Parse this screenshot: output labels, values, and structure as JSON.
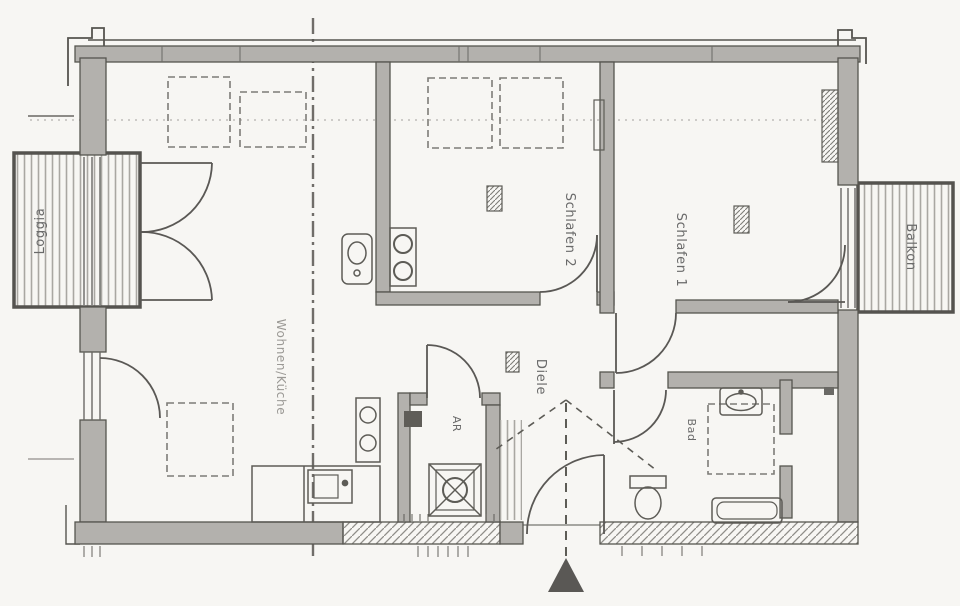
{
  "colors": {
    "paper": "#f7f6f3",
    "ink": "#4f4f4f",
    "ink_light": "#9a9894",
    "wall_fill": "#b3b1ad",
    "label": "#6a6a6a"
  },
  "rooms": {
    "loggia": {
      "label": "Loggia"
    },
    "wohnen": {
      "label": "Wohnen/Küche"
    },
    "schlafen2": {
      "label": "Schlafen 2"
    },
    "schlafen1": {
      "label": "Schlafen 1"
    },
    "balkon": {
      "label": "Balkon"
    },
    "diele": {
      "label": "Diele"
    },
    "ar": {
      "label": "AR"
    },
    "bad": {
      "label": "Bad"
    }
  },
  "symbols": {
    "entrance_arrow": "filled-triangle-up",
    "washing_machine": "square-with-cross-and-circle",
    "section_line": "vertical-dash-dot-line"
  }
}
